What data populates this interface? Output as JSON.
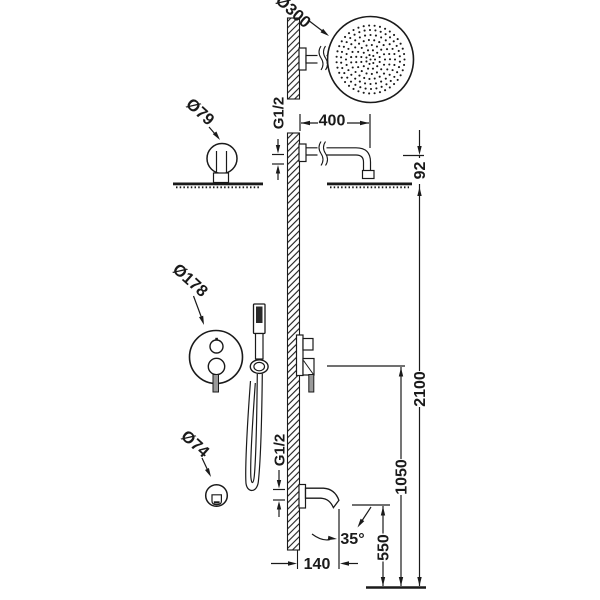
{
  "drawing": {
    "title": "shower-system-installation-drawing",
    "background": "#ffffff",
    "line_color": "#1a1a1a"
  },
  "labels": {
    "head_diameter": "Ø300",
    "arm_escutcheon_diameter": "Ø79",
    "valve_plate_diameter": "Ø178",
    "spout_escutcheon_diameter": "Ø74",
    "arm_thread": "G1/2",
    "spout_thread": "G1/2"
  },
  "dimensions": {
    "arm_length": "400",
    "head_drop": "92",
    "head_height": "2100",
    "valve_height": "1050",
    "spout_height": "550",
    "spout_reach": "140",
    "spout_angle": "35°"
  }
}
